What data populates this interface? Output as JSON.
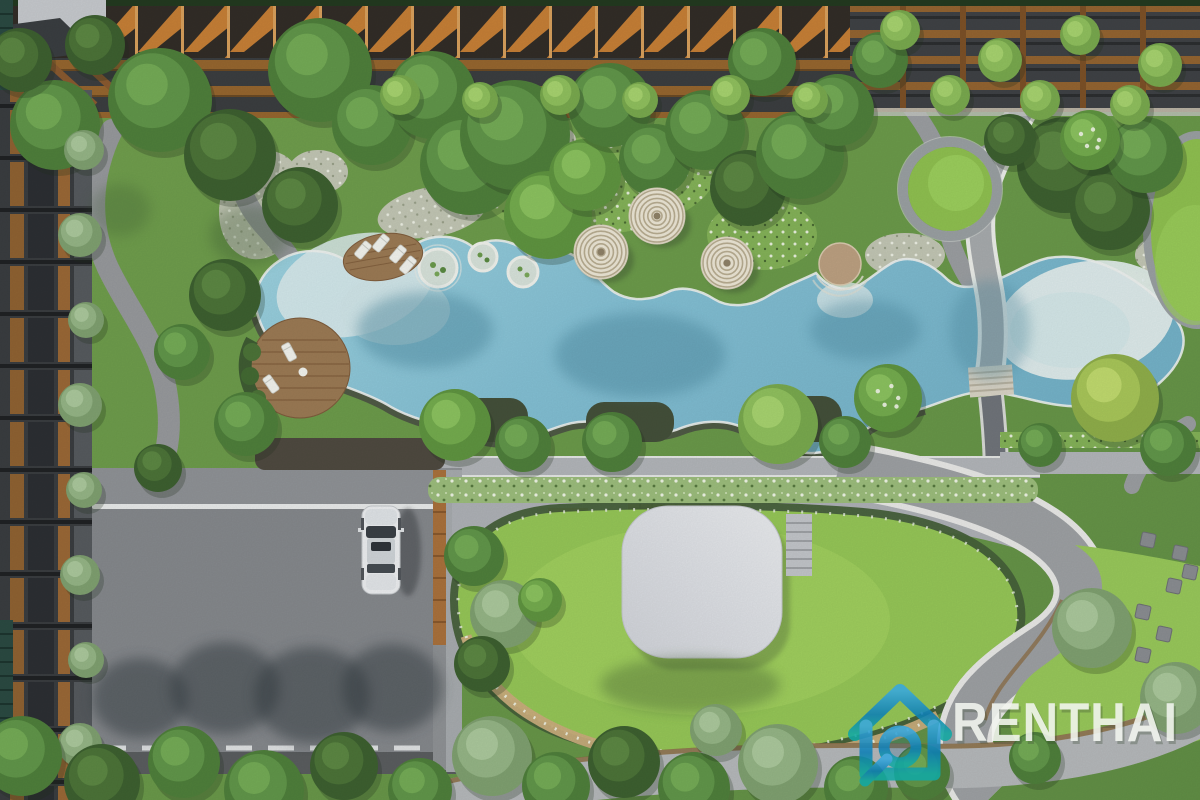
{
  "watermark": {
    "brand_text": "RENTHAI",
    "icon": "house-magnifier-icon",
    "icon_color_top": "#2f9fd9",
    "icon_color_mid": "#0d7fb6",
    "icon_color_bottom": "#12a9a4",
    "text_color": "#f3f6f0"
  },
  "palette": {
    "grass_base": "#6f9d4c",
    "grass_deep": "#5d8a42",
    "lawn_bright": "#95c457",
    "pool_water": "#84c0d4",
    "pool_deep": "#6aacc2",
    "pool_shallow": "#dcebec",
    "path_gray": "#9b9ea1",
    "road_gray": "#85888c",
    "plaza_gray": "#aeb1b6",
    "walk_gray": "#b2b5b9",
    "wall_dark": "#4c5345",
    "wood": "#a9713c",
    "wood_dark": "#8a5a30",
    "deck_wood": "#9b7a54",
    "canopy_cream": "#ece6d5",
    "hedge_dark": "#46603a",
    "hedge_light": "#9cbd7c",
    "building_dark": "#3c3f41",
    "fin_orange": "#c67f36",
    "pavilion": "#dcdee3",
    "car_body": "#eceef0",
    "top_green": "#233a20"
  },
  "scene": {
    "tree_colors": {
      "1": [
        "#3d6030",
        "#4c7338",
        "#5c8743"
      ],
      "2": [
        "#4f7f3b",
        "#61964a",
        "#74ab56"
      ],
      "3": [
        "#5f9440",
        "#74ac4e",
        "#8bc25f"
      ],
      "4": [
        "#79a94e",
        "#90c05e",
        "#a7d36f"
      ],
      "5": [
        "#7fa070",
        "#95b586",
        "#abc89c"
      ],
      "6": [
        "#8fae4a",
        "#a8c659",
        "#c0da6e"
      ]
    },
    "trees": [
      {
        "x": 55,
        "y": 125,
        "r": 45,
        "c": "2"
      },
      {
        "x": 20,
        "y": 60,
        "r": 32,
        "c": "1"
      },
      {
        "x": 95,
        "y": 45,
        "r": 30,
        "c": "1"
      },
      {
        "x": 160,
        "y": 100,
        "r": 52,
        "c": "2"
      },
      {
        "x": 230,
        "y": 155,
        "r": 46,
        "c": "1"
      },
      {
        "x": 320,
        "y": 70,
        "r": 52,
        "c": "2"
      },
      {
        "x": 300,
        "y": 205,
        "r": 38,
        "c": "1"
      },
      {
        "x": 372,
        "y": 125,
        "r": 40,
        "c": "2"
      },
      {
        "x": 432,
        "y": 95,
        "r": 44,
        "c": "2"
      },
      {
        "x": 470,
        "y": 165,
        "r": 50,
        "c": "2"
      },
      {
        "x": 515,
        "y": 135,
        "r": 55,
        "c": "2"
      },
      {
        "x": 548,
        "y": 215,
        "r": 44,
        "c": "3"
      },
      {
        "x": 585,
        "y": 175,
        "r": 36,
        "c": "3"
      },
      {
        "x": 610,
        "y": 105,
        "r": 42,
        "c": "2"
      },
      {
        "x": 655,
        "y": 160,
        "r": 36,
        "c": "2"
      },
      {
        "x": 705,
        "y": 130,
        "r": 40,
        "c": "2"
      },
      {
        "x": 748,
        "y": 188,
        "r": 38,
        "c": "1"
      },
      {
        "x": 800,
        "y": 155,
        "r": 44,
        "c": "2"
      },
      {
        "x": 762,
        "y": 62,
        "r": 34,
        "c": "2"
      },
      {
        "x": 838,
        "y": 110,
        "r": 36,
        "c": "2"
      },
      {
        "x": 880,
        "y": 60,
        "r": 28,
        "c": "2"
      },
      {
        "x": 1065,
        "y": 165,
        "r": 48,
        "c": "1"
      },
      {
        "x": 1110,
        "y": 210,
        "r": 40,
        "c": "1"
      },
      {
        "x": 1145,
        "y": 155,
        "r": 38,
        "c": "2"
      },
      {
        "x": 1090,
        "y": 140,
        "r": 30,
        "c": "3",
        "f": 1
      },
      {
        "x": 1010,
        "y": 140,
        "r": 26,
        "c": "1"
      },
      {
        "x": 400,
        "y": 95,
        "r": 20,
        "c": "4"
      },
      {
        "x": 480,
        "y": 100,
        "r": 18,
        "c": "4"
      },
      {
        "x": 560,
        "y": 95,
        "r": 20,
        "c": "4"
      },
      {
        "x": 640,
        "y": 100,
        "r": 18,
        "c": "4"
      },
      {
        "x": 730,
        "y": 95,
        "r": 20,
        "c": "4"
      },
      {
        "x": 810,
        "y": 100,
        "r": 18,
        "c": "4"
      },
      {
        "x": 900,
        "y": 30,
        "r": 20,
        "c": "4"
      },
      {
        "x": 1000,
        "y": 60,
        "r": 22,
        "c": "4"
      },
      {
        "x": 1080,
        "y": 35,
        "r": 20,
        "c": "4"
      },
      {
        "x": 1160,
        "y": 65,
        "r": 22,
        "c": "4"
      },
      {
        "x": 950,
        "y": 95,
        "r": 20,
        "c": "4"
      },
      {
        "x": 1040,
        "y": 100,
        "r": 20,
        "c": "4"
      },
      {
        "x": 1130,
        "y": 105,
        "r": 20,
        "c": "4"
      },
      {
        "x": 455,
        "y": 425,
        "r": 36,
        "c": "3"
      },
      {
        "x": 523,
        "y": 444,
        "r": 28,
        "c": "2"
      },
      {
        "x": 612,
        "y": 442,
        "r": 30,
        "c": "2"
      },
      {
        "x": 778,
        "y": 424,
        "r": 40,
        "c": "4"
      },
      {
        "x": 845,
        "y": 442,
        "r": 26,
        "c": "2"
      },
      {
        "x": 888,
        "y": 398,
        "r": 34,
        "c": "3",
        "f": 1
      },
      {
        "x": 1115,
        "y": 398,
        "r": 44,
        "c": "6"
      },
      {
        "x": 1168,
        "y": 448,
        "r": 28,
        "c": "2"
      },
      {
        "x": 1040,
        "y": 445,
        "r": 22,
        "c": "2"
      },
      {
        "x": 225,
        "y": 295,
        "r": 36,
        "c": "1"
      },
      {
        "x": 182,
        "y": 352,
        "r": 28,
        "c": "2"
      },
      {
        "x": 246,
        "y": 424,
        "r": 32,
        "c": "2"
      },
      {
        "x": 158,
        "y": 468,
        "r": 24,
        "c": "1"
      },
      {
        "x": 84,
        "y": 150,
        "r": 20,
        "c": "5"
      },
      {
        "x": 80,
        "y": 235,
        "r": 22,
        "c": "5"
      },
      {
        "x": 86,
        "y": 320,
        "r": 18,
        "c": "5"
      },
      {
        "x": 80,
        "y": 405,
        "r": 22,
        "c": "5"
      },
      {
        "x": 84,
        "y": 490,
        "r": 18,
        "c": "5"
      },
      {
        "x": 80,
        "y": 575,
        "r": 20,
        "c": "5"
      },
      {
        "x": 86,
        "y": 660,
        "r": 18,
        "c": "5"
      },
      {
        "x": 80,
        "y": 745,
        "r": 22,
        "c": "5"
      },
      {
        "x": 474,
        "y": 556,
        "r": 30,
        "c": "2"
      },
      {
        "x": 504,
        "y": 614,
        "r": 34,
        "c": "5"
      },
      {
        "x": 482,
        "y": 664,
        "r": 28,
        "c": "1"
      },
      {
        "x": 540,
        "y": 600,
        "r": 22,
        "c": "3"
      },
      {
        "x": 1092,
        "y": 628,
        "r": 40,
        "c": "5"
      },
      {
        "x": 1176,
        "y": 698,
        "r": 36,
        "c": "5"
      },
      {
        "x": 1035,
        "y": 758,
        "r": 26,
        "c": "2"
      },
      {
        "x": 22,
        "y": 756,
        "r": 40,
        "c": "2"
      },
      {
        "x": 102,
        "y": 782,
        "r": 38,
        "c": "1"
      },
      {
        "x": 184,
        "y": 762,
        "r": 36,
        "c": "2"
      },
      {
        "x": 264,
        "y": 790,
        "r": 40,
        "c": "2"
      },
      {
        "x": 344,
        "y": 766,
        "r": 34,
        "c": "1"
      },
      {
        "x": 420,
        "y": 790,
        "r": 32,
        "c": "2"
      },
      {
        "x": 492,
        "y": 756,
        "r": 40,
        "c": "5"
      },
      {
        "x": 556,
        "y": 786,
        "r": 34,
        "c": "2"
      },
      {
        "x": 624,
        "y": 762,
        "r": 36,
        "c": "1"
      },
      {
        "x": 694,
        "y": 788,
        "r": 36,
        "c": "2"
      },
      {
        "x": 716,
        "y": 730,
        "r": 26,
        "c": "5"
      },
      {
        "x": 778,
        "y": 764,
        "r": 40,
        "c": "5"
      },
      {
        "x": 856,
        "y": 788,
        "r": 32,
        "c": "2"
      },
      {
        "x": 922,
        "y": 772,
        "r": 28,
        "c": "2"
      }
    ],
    "canopies": [
      {
        "x": 601,
        "y": 252,
        "r": 27
      },
      {
        "x": 657,
        "y": 216,
        "r": 28
      },
      {
        "x": 727,
        "y": 263,
        "r": 26
      }
    ],
    "loungers": [
      {
        "x": 363,
        "y": 250,
        "a": 40
      },
      {
        "x": 381,
        "y": 243,
        "a": 40
      },
      {
        "x": 398,
        "y": 254,
        "a": 40
      },
      {
        "x": 408,
        "y": 265,
        "a": 40
      },
      {
        "x": 289,
        "y": 352,
        "a": -28
      },
      {
        "x": 271,
        "y": 384,
        "a": -35
      }
    ],
    "seats": [
      {
        "x": 1148,
        "y": 540
      },
      {
        "x": 1180,
        "y": 553
      },
      {
        "x": 1190,
        "y": 572
      },
      {
        "x": 1174,
        "y": 586
      },
      {
        "x": 1143,
        "y": 612
      },
      {
        "x": 1164,
        "y": 634
      },
      {
        "x": 1143,
        "y": 655
      }
    ],
    "shadows": [
      {
        "x": 140,
        "y": 698,
        "rx": 48,
        "ry": 40,
        "c": "#363c42",
        "o": 0.5
      },
      {
        "x": 225,
        "y": 688,
        "rx": 55,
        "ry": 46,
        "c": "#363c42",
        "o": 0.5
      },
      {
        "x": 312,
        "y": 695,
        "rx": 58,
        "ry": 48,
        "c": "#363c42",
        "o": 0.5
      },
      {
        "x": 392,
        "y": 688,
        "rx": 50,
        "ry": 44,
        "c": "#363c42",
        "o": 0.5
      },
      {
        "x": 425,
        "y": 330,
        "rx": 68,
        "ry": 38,
        "c": "#4e8aa0",
        "o": 0.45
      },
      {
        "x": 640,
        "y": 355,
        "rx": 85,
        "ry": 42,
        "c": "#4e8aa0",
        "o": 0.45
      },
      {
        "x": 865,
        "y": 330,
        "rx": 55,
        "ry": 30,
        "c": "#4e8aa0",
        "o": 0.4
      },
      {
        "x": 990,
        "y": 330,
        "rx": 40,
        "ry": 50,
        "c": "#4e8aa0",
        "o": 0.35
      },
      {
        "x": 690,
        "y": 685,
        "rx": 90,
        "ry": 28,
        "c": "#3f5c33",
        "o": 0.35
      },
      {
        "x": 250,
        "y": 235,
        "rx": 40,
        "ry": 30,
        "c": "#3a5a30",
        "o": 0.3
      },
      {
        "x": 120,
        "y": 210,
        "rx": 30,
        "ry": 26,
        "c": "#3a5a30",
        "o": 0.25
      }
    ]
  }
}
